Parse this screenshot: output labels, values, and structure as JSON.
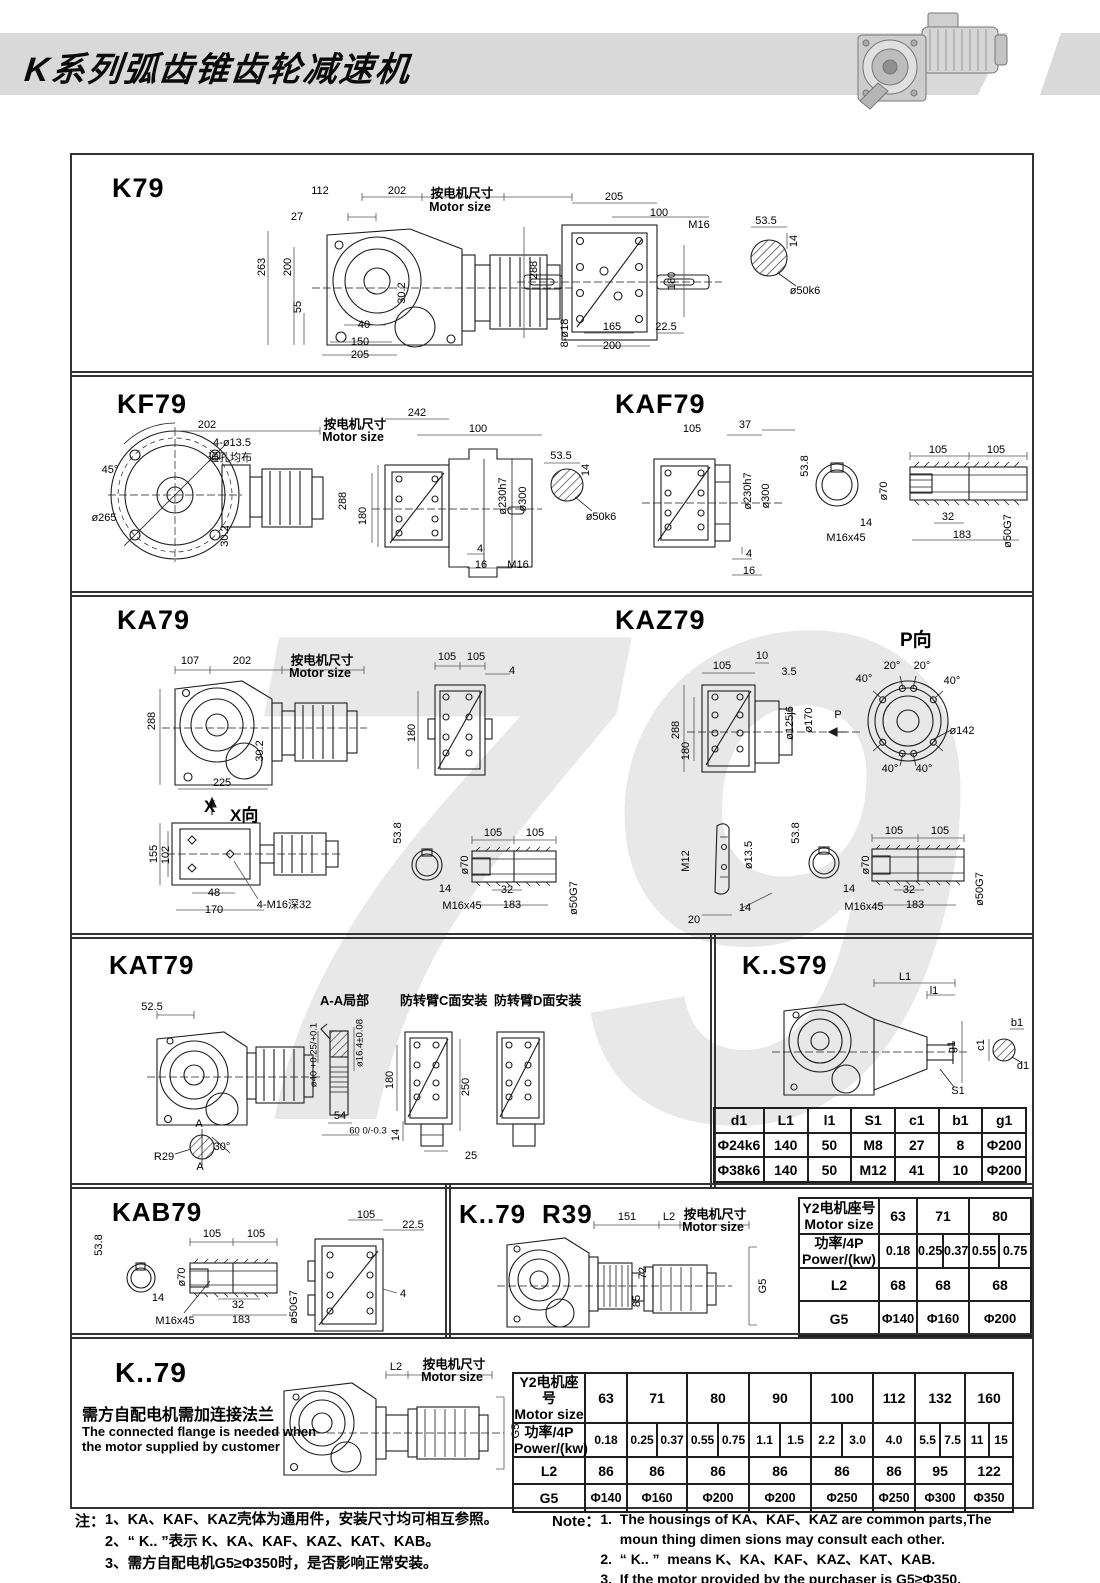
{
  "header": {
    "title": "K系列弧齿锥齿轮减速机"
  },
  "watermark": "79",
  "p1": {
    "t": "K79",
    "mcn": "按电机尺寸",
    "men": "Motor size",
    "d": [
      "112",
      "202",
      "27",
      "263",
      "200",
      "55",
      "30.2",
      "40",
      "150",
      "205",
      "205",
      "100",
      "M16",
      "288",
      "180",
      "8-ø18",
      "165",
      "22.5",
      "200",
      "53.5",
      "14",
      "ø50k6"
    ]
  },
  "p2": {
    "t1": "KF79",
    "t2": "KAF79",
    "mcn": "按电机尺寸",
    "men": "Motor size",
    "d": [
      "202",
      "4-ø13.5",
      "通孔均布",
      "45°",
      "ø265",
      "30.2",
      "242",
      "100",
      "288",
      "180",
      "ø230h7",
      "ø300",
      "4",
      "16",
      "M16",
      "53.5",
      "14",
      "ø50k6",
      "105",
      "37",
      "ø230h7",
      "ø300",
      "4",
      "16",
      "53.8",
      "ø70",
      "105",
      "105",
      "14",
      "M16x45",
      "32",
      "183",
      "ø50G7"
    ]
  },
  "p3": {
    "t1": "KA79",
    "t2": "KAZ79",
    "pv": "P向",
    "xm": "X",
    "xv": "X向",
    "mcn": "按电机尺寸",
    "men": "Motor size",
    "d": [
      "107",
      "202",
      "288",
      "30.2",
      "225",
      "105",
      "105",
      "4",
      "180",
      "105",
      "10",
      "3.5",
      "288",
      "180",
      "ø125j6",
      "ø170",
      "P",
      "20°",
      "20°",
      "40°",
      "40°",
      "ø142",
      "40°",
      "40°",
      "155",
      "102",
      "48",
      "170",
      "4-M16深32",
      "53.8",
      "14",
      "105",
      "105",
      "ø70",
      "32",
      "M16x45",
      "183",
      "ø50G7",
      "M12",
      "ø13.5",
      "14",
      "20",
      "53.8",
      "14",
      "105",
      "105",
      "ø70",
      "32",
      "M16x45",
      "183",
      "ø50G7"
    ]
  },
  "p4": {
    "t": "KAT79",
    "aa": "A-A局部",
    "c": "防转臂C面安装",
    "dv": "防转臂D面安装",
    "d": [
      "52.5",
      "R29",
      "30°",
      "A",
      "A",
      "ø40 +0.25/+0.1",
      "ø16.4±0.08",
      "54",
      "60 0/-0.3",
      "180",
      "14",
      "250",
      "25"
    ]
  },
  "p5": {
    "t": "K..S79",
    "d": [
      "L1",
      "l1",
      "g1",
      "S1",
      "c1",
      "b1",
      "d1"
    ],
    "table": {
      "h": [
        "d1",
        "L1",
        "l1",
        "S1",
        "c1",
        "b1",
        "g1"
      ],
      "r1": [
        "Φ24k6",
        "140",
        "50",
        "M8",
        "27",
        "8",
        "Φ200"
      ],
      "r2": [
        "Φ38k6",
        "140",
        "50",
        "M12",
        "41",
        "10",
        "Φ200"
      ]
    }
  },
  "p6": {
    "t": "KAB79",
    "d": [
      "53.8",
      "14",
      "M16x45",
      "105",
      "105",
      "ø70",
      "32",
      "183",
      "ø50G7",
      "105",
      "22.5",
      "4"
    ]
  },
  "p7": {
    "t1": "K..79",
    "t2": "R39",
    "mcn": "按电机尺寸",
    "men": "Motor size",
    "d": [
      "151",
      "L2",
      "72",
      "85",
      "G5"
    ],
    "table": {
      "rh1a": "Y2电机座号",
      "rh1b": "Motor size",
      "rh2a": "功率/4P",
      "rh2b": "Power/(kw)",
      "rh3": "L2",
      "rh4": "G5",
      "sizes": [
        "63",
        "71",
        "80"
      ],
      "powers": [
        "0.18",
        "0.25",
        "0.37",
        "0.55",
        "0.75"
      ],
      "l2": [
        "68",
        "68",
        "68"
      ],
      "g5": [
        "Φ140",
        "Φ160",
        "Φ200"
      ]
    }
  },
  "p8": {
    "t": "K..79",
    "cn": "需方自配电机需加连接法兰",
    "en1": "The connected flange is needed when",
    "en2": "the motor supplied by customer",
    "mcn": "按电机尺寸",
    "men": "Motor size",
    "d": [
      "L2",
      "G5"
    ],
    "table": {
      "rh1a": "Y2电机座号",
      "rh1b": "Motor size",
      "rh2a": "功率/4P",
      "rh2b": "Power/(kw)",
      "rh3": "L2",
      "rh4": "G5",
      "sizes": [
        "63",
        "71",
        "80",
        "90",
        "100",
        "112",
        "132",
        "160"
      ],
      "powers": [
        "0.18",
        "0.25",
        "0.37",
        "0.55",
        "0.75",
        "1.1",
        "1.5",
        "2.2",
        "3.0",
        "4.0",
        "5.5",
        "7.5",
        "11",
        "15"
      ],
      "l2": [
        "86",
        "86",
        "86",
        "86",
        "86",
        "86",
        "95",
        "122"
      ],
      "g5": [
        "Φ140",
        "Φ160",
        "Φ200",
        "Φ200",
        "Φ250",
        "Φ250",
        "Φ300",
        "Φ350"
      ]
    }
  },
  "notes": {
    "cn_label": "注：",
    "cn": [
      "1、KA、KAF、KAZ壳体为通用件，安装尺寸均可相互参照。",
      "2、“ K.. ”表示 K、KA、KAF、KAZ、KAT、KAB。",
      "3、需方自配电机G5≥Φ350时，是否影响正常安装。"
    ],
    "en_label": "Note：",
    "en": [
      "1.  The housings of KA、KAF、KAZ are common parts,The",
      "     moun thing dimen sions may consult each other.",
      "2.  “ K.. ”  means K、KA、KAF、KAZ、KAT、KAB.",
      "3.  If the motor provided by the purchaser is G5≥Φ350,",
      "     please check if normal installation is influenced."
    ]
  }
}
